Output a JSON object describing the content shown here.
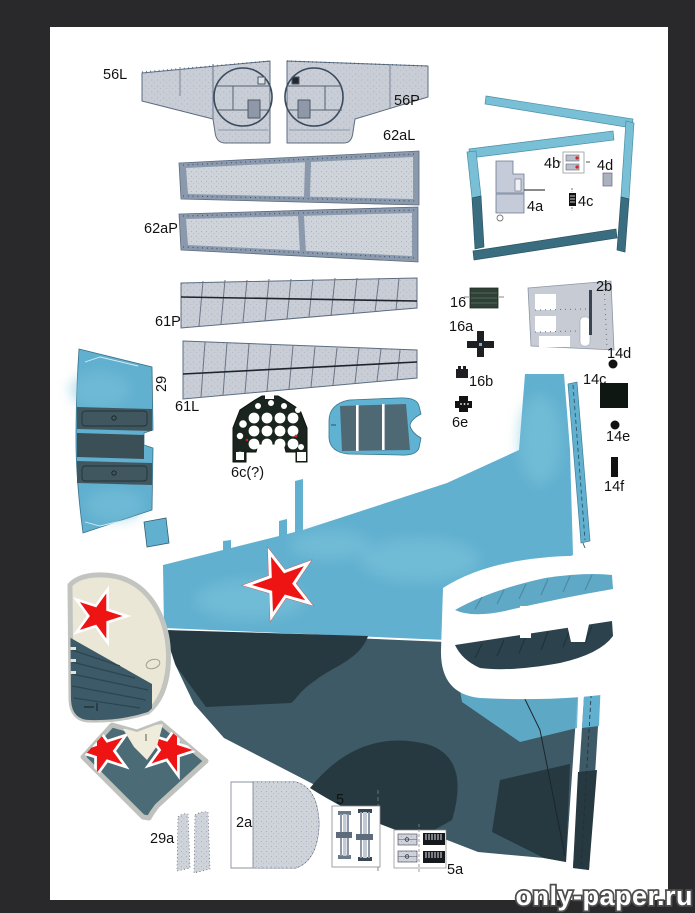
{
  "watermark": "only-paper.ru",
  "labels": {
    "56L": "56L",
    "56P": "56P",
    "62aL": "62aL",
    "62aP": "62aP",
    "61P": "61P",
    "61L": "61L",
    "29": "29",
    "6c": "6c(?)",
    "4a": "4a",
    "4b": "4b",
    "4c": "4c",
    "4d": "4d",
    "16": "16",
    "16a": "16a",
    "16b": "16b",
    "6e": "6e",
    "2b": "2b",
    "14d": "14d",
    "14c": "14c",
    "14e": "14e",
    "14f": "14f",
    "29a": "29a",
    "2a": "2a",
    "5": "5",
    "5a": "5a"
  },
  "colors": {
    "viewer_background": "#29292b",
    "paper": "#ffffff",
    "sky_blue": "#61b0cf",
    "teal_strip_light": "#79c0d6",
    "teal_strip_dark": "#3a6d80",
    "camo_slate": "#3d5a66",
    "camo_charcoal": "#263840",
    "star_red": "#ee1414",
    "fin_cream": "#ebe7d7",
    "part_gray": "#ccd0d7",
    "panel_border_blue": "#8b99ad",
    "instrument_panel_dark": "#1b251f"
  }
}
